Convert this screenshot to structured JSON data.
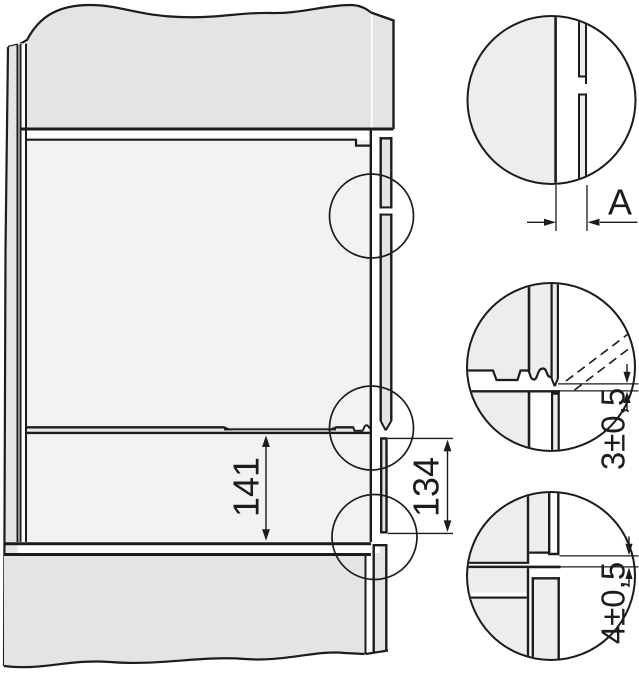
{
  "diagram": {
    "type": "built-in appliance installation section drawing",
    "labels": {
      "niche_height": "141",
      "lower_front_height": "134",
      "front_gap": "A",
      "upper_gap": "3±0,5",
      "lower_gap": "4±0,5"
    },
    "colors": {
      "line": "#1c1c1c",
      "panel_gray": "#e4e4e4",
      "interior_gray": "#f2f2f2",
      "detail_gray": "#ededed",
      "background": "#ffffff"
    }
  }
}
